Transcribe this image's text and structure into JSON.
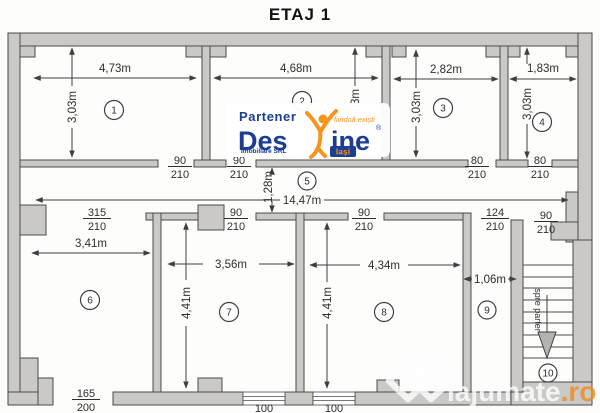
{
  "title": "ETAJ 1",
  "rooms": {
    "r1": {
      "no": "1",
      "w": "4,73m",
      "h": "3,03m"
    },
    "r2": {
      "no": "2",
      "w": "4,68m",
      "h": "3,03m"
    },
    "r3": {
      "no": "3",
      "w": "2,82m",
      "h": "3,03m"
    },
    "r4": {
      "no": "4",
      "w": "1,83m",
      "h": "3,03m"
    },
    "r5": {
      "no": "5",
      "len": "14,47m",
      "w": "1,28m"
    },
    "r6": {
      "no": "6",
      "w": "3,41m"
    },
    "r7": {
      "no": "7",
      "w": "3,56m",
      "h": "4,41m"
    },
    "r8": {
      "no": "8",
      "w": "4,34m",
      "h": "4,41m"
    },
    "r9": {
      "no": "9",
      "w": "1,06m"
    },
    "r10": {
      "no": "10",
      "note": "spre parter"
    }
  },
  "doors": {
    "d1": {
      "w": "90",
      "h": "210"
    },
    "d2": {
      "w": "90",
      "h": "210"
    },
    "d3": {
      "w": "80",
      "h": "210"
    },
    "d4": {
      "w": "80",
      "h": "210"
    },
    "hall": {
      "w": "315",
      "h": "210"
    },
    "d7": {
      "w": "90",
      "h": "210"
    },
    "d8": {
      "w": "90",
      "h": "210"
    },
    "d9": {
      "w": "124",
      "h": "210"
    },
    "dstairs": {
      "w": "90",
      "h": "210"
    }
  },
  "windows": {
    "w6": {
      "w": "165",
      "h": "200"
    },
    "w7": {
      "w": "100"
    },
    "w8": {
      "w": "100"
    }
  },
  "logo": {
    "partener": "Partener",
    "brand_left": "Des",
    "brand_right": "ine",
    "registered": "®",
    "tagline": "fiindcă exiști",
    "subtitle": "Imobiliare SRL",
    "city": "Iași",
    "blue": "#1c3e92",
    "orange": "#f7941d"
  },
  "site_watermark": {
    "name": "lajumate",
    "tld": ".ro",
    "orange": "#ef8b1e"
  },
  "colors": {
    "wall_fill": "#cbc9c5",
    "line": "#3f3f3f",
    "text": "#2e2e2e",
    "paper": "#fdfdfc"
  }
}
